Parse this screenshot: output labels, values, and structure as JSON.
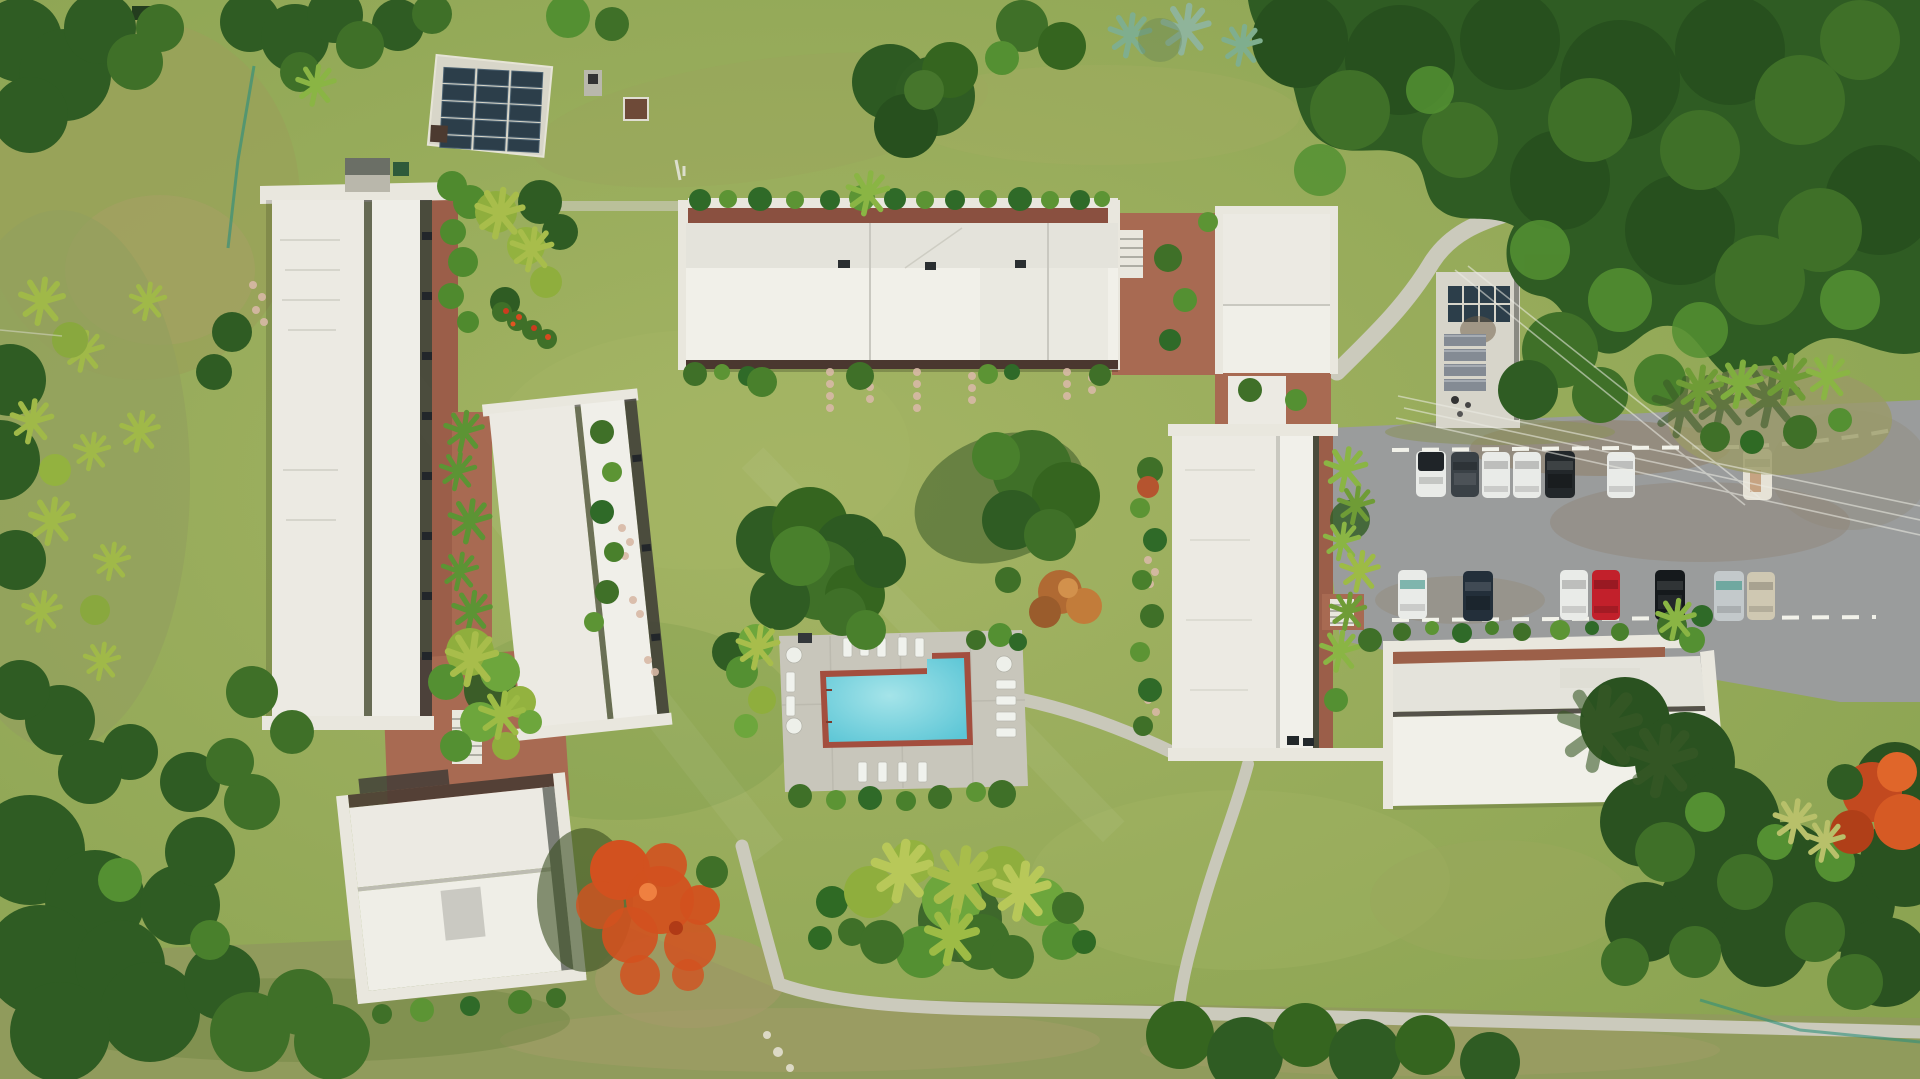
{
  "scene": {
    "type": "aerial-drone-photo",
    "description": "Top-down drone view of a tropical condo/resort complex: seven white flat-roofed buildings around a central mowed lawn, L-shaped turquoise swimming pool with sun loungers on a concrete deck, gravel parking lot with two rows of parked cars, red-brick courtyards with palms, concrete walkways, solar panel arrays, flamboyant trees with orange blooms, and dense perimeter forest",
    "time_of_day": "midday"
  },
  "palette": {
    "lawn": "#8aa351",
    "lawn_light": "#a4b464",
    "scrub": "#96a15c",
    "tan": "#a8a167",
    "tree_dark": "#2f5c23",
    "tree_darker": "#27501e",
    "tree_mid": "#3f7028",
    "tree_bright": "#549032",
    "tree_light": "#6da63c",
    "palm": "#93b23f",
    "palm_pale": "#aebf52",
    "roof_white": "#eceae3",
    "roof_bright": "#f1f0e9",
    "roof_dim": "#e4e3db",
    "eave": "#e9e7de",
    "seam": "#bdbcb2",
    "trim_dark": "#4a372f",
    "balcony_dark": "#3c3a36",
    "brick": "#a86a52",
    "brick_dark": "#9b5e49",
    "walkway_brown": "#8a5040",
    "path": "#cbcabc",
    "deck": "#c8c6bb",
    "pool_water": "#5cc6d6",
    "pool_water_light": "#a5e4e9",
    "pool_tile": "#a34e3e",
    "gravel": "#9a9c9c",
    "dirt_road": "#8a6a4c",
    "flamboyant": "#d2511f",
    "fence": "#2f8f7c",
    "white_line": "#f2f2ea",
    "shadow_green": "#3a5a28",
    "solar_panel": "#2c3e4a"
  },
  "objects": {
    "buildings": [
      {
        "id": "west-long-building",
        "roof": "white flat, dark ridge seam, balcony strip east"
      },
      {
        "id": "west-inner-building",
        "roof": "white flat, tilted slightly"
      },
      {
        "id": "southwest-building",
        "roof": "white flat, dark trim north edge"
      },
      {
        "id": "north-center-building",
        "roof": "white flat, brick walkway north"
      },
      {
        "id": "northeast-building",
        "roof": "white flat, brick courtyard west"
      },
      {
        "id": "east-center-building",
        "roof": "white flat, brick walkway east, stairs"
      },
      {
        "id": "southeast-building",
        "roof": "white flat, brick walkway north"
      },
      {
        "id": "utility-building",
        "roof": "concrete with 8 solar panels and louvers"
      },
      {
        "id": "solar-array-ground",
        "roof": "15 dark panels in 3 columns on concrete pad"
      }
    ],
    "pool": {
      "shape": "rectangle with raised notch at northeast corner",
      "water": "turquoise",
      "border": "maroon tile",
      "deck": "concrete",
      "loungers": 15,
      "round_tables": 3
    },
    "parking": {
      "surface": "gray gravel with dirt patches",
      "top_row": [
        {
          "type": "pickup",
          "color": "#e9ebe8",
          "accent": "#1f2428"
        },
        {
          "type": "car",
          "color": "#3a4146"
        },
        {
          "type": "car",
          "color": "#e9ebe8"
        },
        {
          "type": "car",
          "color": "#e9ebe8"
        },
        {
          "type": "suv",
          "color": "#22272a"
        },
        {
          "type": "car",
          "color": "#e9ebe8"
        },
        {
          "type": "van",
          "color": "#e6e2d6"
        }
      ],
      "bottom_row": [
        {
          "type": "car",
          "color": "#e9ebe8"
        },
        {
          "type": "car",
          "color": "#232f3a"
        },
        {
          "type": "car",
          "color": "#e9ebe8"
        },
        {
          "type": "car",
          "color": "#c2202b"
        },
        {
          "type": "car",
          "color": "#15191c"
        },
        {
          "type": "car",
          "color": "#c3c9cb"
        },
        {
          "type": "car",
          "color": "#cfc8b2"
        }
      ],
      "markings": "white dashed stall lines"
    },
    "vegetation": {
      "flamboyant_trees": 2,
      "central_tree_clusters": 2,
      "palm_clusters": "along courtyards, pool, south lawn, east island",
      "agaves": "north lawn and east island",
      "perimeter": "dense forest on north, east, west and south edges"
    },
    "infrastructure": {
      "paths": "concrete walkways linking buildings, pool and parking",
      "power_lines": "overhead wires crossing east side",
      "fences": "teal wire fence west edge and southeast edge",
      "stepping_stones": "pink pavers below north building and along gardens"
    }
  }
}
